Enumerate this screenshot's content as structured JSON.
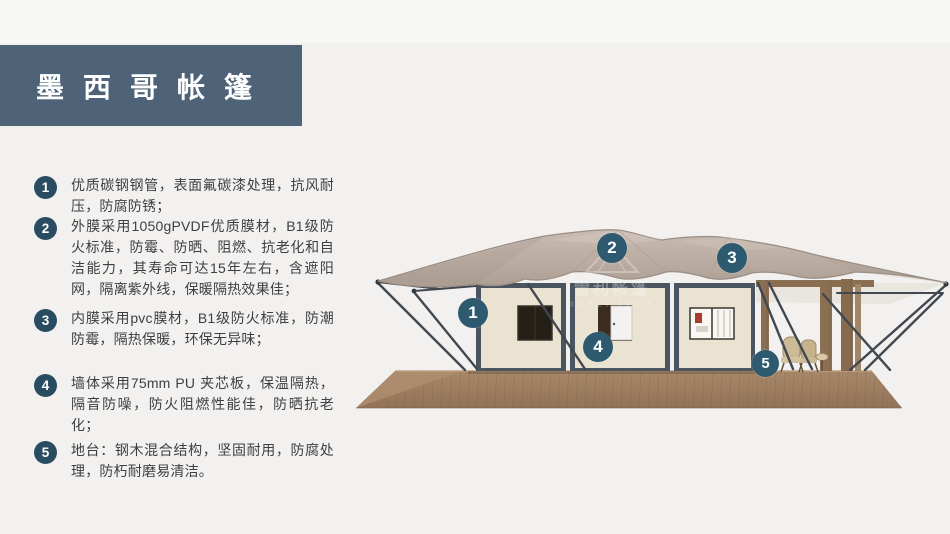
{
  "page": {
    "background_color": "#f2f1f0"
  },
  "title": {
    "text": "墨西哥帐篷",
    "bar_color": "#4e6377"
  },
  "features": [
    {
      "num": "1",
      "text": "优质碳钢钢管，表面氟碳漆处理，抗风耐压，防腐防锈；"
    },
    {
      "num": "2",
      "text": "外膜采用1050gPVDF优质膜材，B1级防火标准，防霉、防晒、阻燃、抗老化和自洁能力，其寿命可达15年左右，含遮阳网，隔离紫外线，保暖隔热效果佳；"
    },
    {
      "num": "3",
      "text": "内膜采用pvc膜材，B1级防火标准，防潮防霉，隔热保暖，环保无异味；"
    },
    {
      "num": "4",
      "text": "墙体采用75mm PU 夹芯板，保温隔热，隔音防噪，防火阻燃性能佳，防晒抗老化；"
    },
    {
      "num": "5",
      "text": "地台：钢木混合结构，坚固耐用，防腐处理，防朽耐磨易清洁。"
    }
  ],
  "figure": {
    "description": "mexico-safari-tent-rendering",
    "watermark": {
      "cn": "雪利帐篷",
      "en": "XUELI TENT"
    },
    "callouts": [
      {
        "num": "1"
      },
      {
        "num": "2"
      },
      {
        "num": "3"
      },
      {
        "num": "4"
      },
      {
        "num": "5"
      }
    ],
    "colors": {
      "roof": "#b9aba0",
      "wall": "#eae3d2",
      "frame": "#4a5560",
      "deck": "#9d7e5f",
      "callout_badge": "#2e5a70"
    }
  }
}
